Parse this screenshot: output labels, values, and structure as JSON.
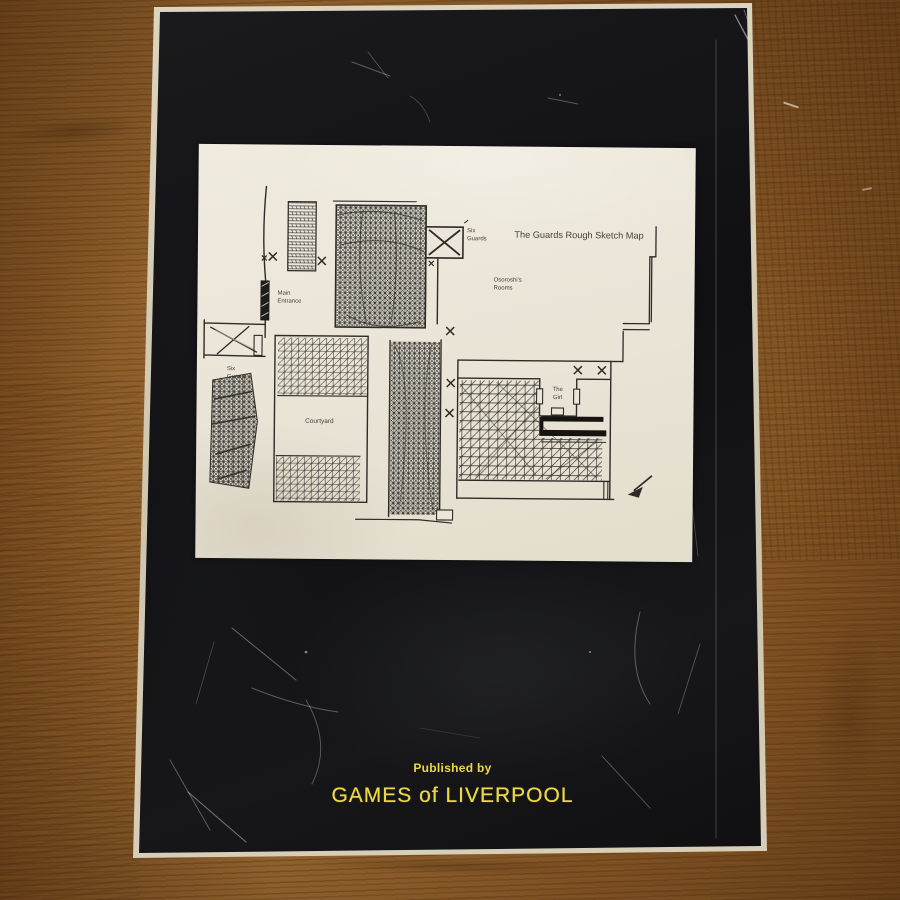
{
  "book": {
    "publisher": {
      "line1": "Published by",
      "line2": "GAMES of LIVERPOOL",
      "text_color": "#ecd843"
    }
  },
  "map": {
    "title": "The Guards Rough Sketch Map",
    "labels": {
      "six_guards_top": {
        "line1": "Six",
        "line2": "Guards"
      },
      "osoroshi_rooms": {
        "line1": "Osoroshi's",
        "line2": "Rooms"
      },
      "main_entrance": {
        "line1": "Main",
        "line2": "Entrance"
      },
      "six_guards_left": {
        "line1": "Six",
        "line2": "Guards"
      },
      "courtyard": "Courtyard",
      "the_girl": {
        "line1": "The",
        "line2": "Girl"
      }
    },
    "ink_color": "#2e2b26",
    "paper_color": "#ebe6d9"
  }
}
